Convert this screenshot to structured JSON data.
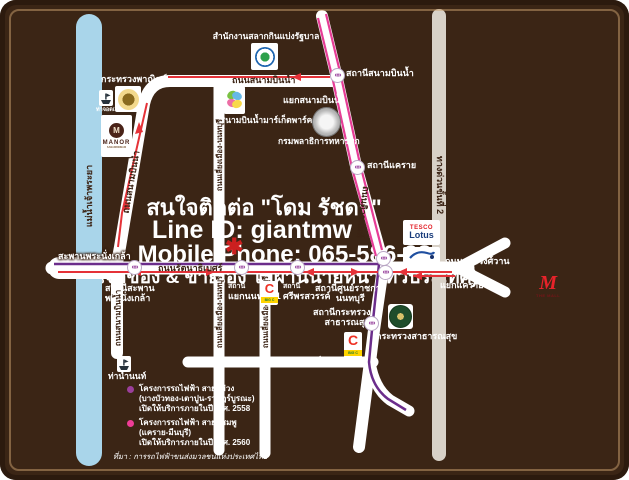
{
  "colors": {
    "background": "#3B2515",
    "road": "#ffffff",
    "river": "#A9D5EA",
    "expressway": "#D8D1C7",
    "route_red": "#E53238",
    "mrt_purple": "#6B2D8B",
    "mrt_pink": "#E63D96",
    "marker_red": "#CC1F1F"
  },
  "overlay": {
    "contact": "สนใจติดต่อ \"โดม รัชดา\"",
    "line_id": "Line ID: giantmw",
    "phone": "Mobile Phone: 065-586-987",
    "owner_note": "(เจ้าของ & ขายเอง ไม่ผ่านนายหน้า ทั่วประเทศ)"
  },
  "river": {
    "label": "แม่น้ำเจ้าพระยา"
  },
  "roads": {
    "sanambinnam_top": "ถนนสนามบินน้ำ",
    "sanambinnam_upper_vertical": "ถนนสนามบินน้ำ",
    "sanambinnam_lower_vertical": "ถนนสนามบินน้ำ",
    "liang_mueang_upper": "ถนนเลี่ยงเมือง-นนทบุรี",
    "liang_mueang_lower": "ถนนเลี่ยงเมือง-นนทบุรี",
    "liang_mueang_lower2": "ถนนเลี่ยงเมือง-นนทบุรี",
    "tiwanon": "ถนนติวานนท์",
    "rattanathibet": "ถนนรัตนาธิเบศร์",
    "ngamwongwan": "ถนนงามวงศ์วาน",
    "pracharat": "ถนนประชาราษฎร์",
    "expressway": "ทางด่วนขั้นที่ 2",
    "bridge": "สะพานพระนั่งเกล้า"
  },
  "junctions": {
    "sanambinnam": "แยกสนามบินน้ำ",
    "khaerai": "แยกแคราย"
  },
  "stations": {
    "sanambinnam": "สถานีสนามบินน้ำ",
    "khaerai": "สถานีแคราย",
    "phra_nangklao_l1": "สถานีสะพาน",
    "phra_nangklao_l2": "พระนั่งเกล้า",
    "yaek_nonthaburi_l1": "สถานี",
    "yaek_nonthaburi_l2": "แยกนนทบุรี 1",
    "sri_phonsawan_l1": "สถานี",
    "sri_phonsawan_l2": "ศรีพรสวรรค์",
    "civic_center_l1": "สถานีศูนย์ราชการ",
    "civic_center_l2": "นนทบุรี",
    "moph_l1": "สถานีกระทรวง",
    "moph_l2": "สาธารณสุข"
  },
  "places": {
    "lottery_office": "สำนักงานสลากกินแบ่งรัฐบาล",
    "commerce_ministry": "กระทรวงพาณิชย์",
    "pier_top": "ท่าจอดเรือ",
    "manor": "MANOR",
    "manor_sub": "SANAMBINNAM",
    "market_park": "สนามบินน้ำมาร์เก็ตพาร์ค",
    "quartermaster": "กรมพลาธิการทหารบก",
    "moph": "กระทรวงสาธารณสุข",
    "pier_bottom": "ท่าน้ำนนท์",
    "tesco": "TESCO",
    "tesco_sub": "Lotus",
    "the_mall_m": "M",
    "the_mall": "THE MALL",
    "bigc": "BIG C",
    "bigc_c": "C"
  },
  "icons": [
    "mrt-station-icon",
    "boat-pier-icon",
    "lottery-office-seal",
    "commerce-ministry-seal",
    "quartermaster-seal",
    "public-health-seal",
    "manor-logo",
    "market-park-logo",
    "tesco-lotus-logo",
    "central-plaza-logo",
    "big-c-logo",
    "the-mall-logo",
    "location-flower-marker"
  ],
  "legend": {
    "purple": {
      "l1": "โครงการรถไฟฟ้า สายสีม่วง",
      "l2": "(บางบัวทอง-เตาปูน-ราษฎร์บูรณะ)",
      "l3": "เปิดให้บริการภายในปี พ.ศ. 2558",
      "color": "#9B3F9B"
    },
    "pink": {
      "l1": "โครงการรถไฟฟ้า สายสีชมพู",
      "l2": "(แคราย-มีนบุรี)",
      "l3": "เปิดให้บริการภายในปี พ.ศ. 2560",
      "color": "#EF3D97"
    },
    "source": "ที่มา : การรถไฟฟ้าขนส่งมวลชนแห่งประเทศไทย"
  }
}
